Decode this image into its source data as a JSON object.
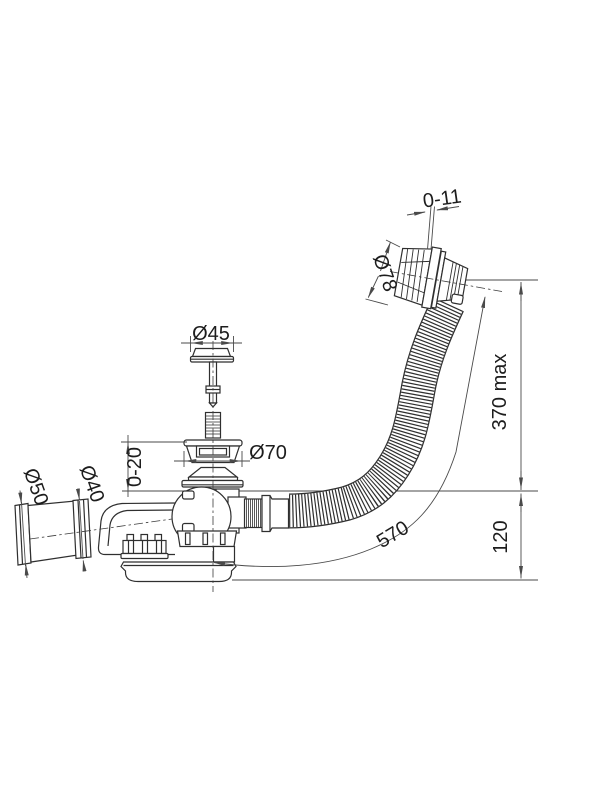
{
  "drawing": {
    "labels": {
      "overflow_travel": "0-11",
      "overflow_diameter": "Ø78",
      "plug_diameter": "Ø45",
      "flange_diameter": "Ø70",
      "flange_height_adjust": "0-20",
      "outlet_sleeve_diameter": "Ø50",
      "outlet_pipe_diameter": "Ø40",
      "hose_length": "570",
      "overflow_height_max": "370 max",
      "trap_depth": "120"
    },
    "colors": {
      "line": "#2f2f2f",
      "dimension": "#4a4a4a",
      "text": "#1d1d1d",
      "background": "#ffffff"
    }
  }
}
